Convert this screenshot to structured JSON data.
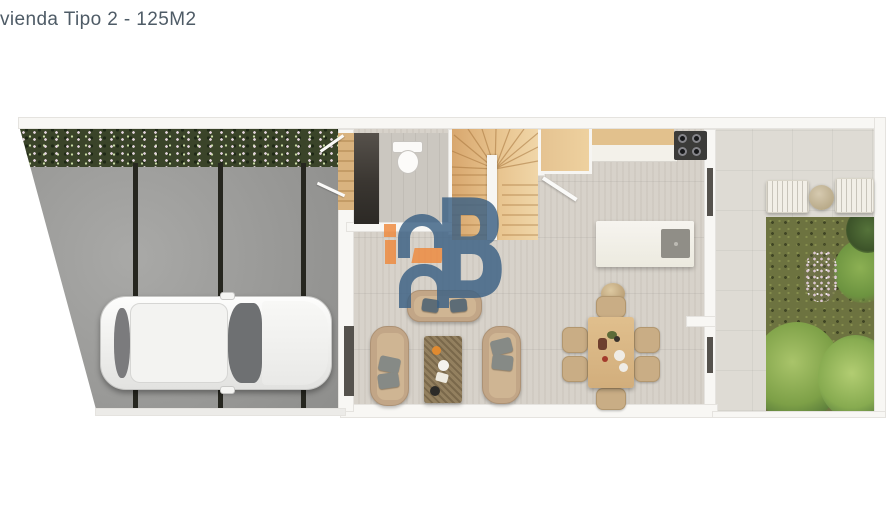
{
  "header": {
    "title": "vienda Tipo 2 - 125M2"
  },
  "watermark": {
    "letter": "B",
    "blue": "#3d6285",
    "orange": "#ef8a3e"
  },
  "palette": {
    "background": "#ffffff",
    "title_text": "#4e5b66",
    "wall": "#f8f7f4",
    "driveway_concrete": "#9c9c9a",
    "driveway_joint": "#26261f",
    "flower_bed_green": "#3a4429",
    "interior_floor": "#d7d2ca",
    "patio_tile": "#dedbd4",
    "stair_wood": "#e2b97f",
    "kitchen_wood": "#e2c18d",
    "marble_counter": "#f3f1ea",
    "stove_black": "#3b3b39",
    "sofa_tan": "#c2a687",
    "dining_wood": "#d9b786",
    "garden_grass": "#6d7340",
    "bush_green": "#7da047",
    "car_white": "#f6f6f4",
    "door_dark": "#55524d"
  }
}
